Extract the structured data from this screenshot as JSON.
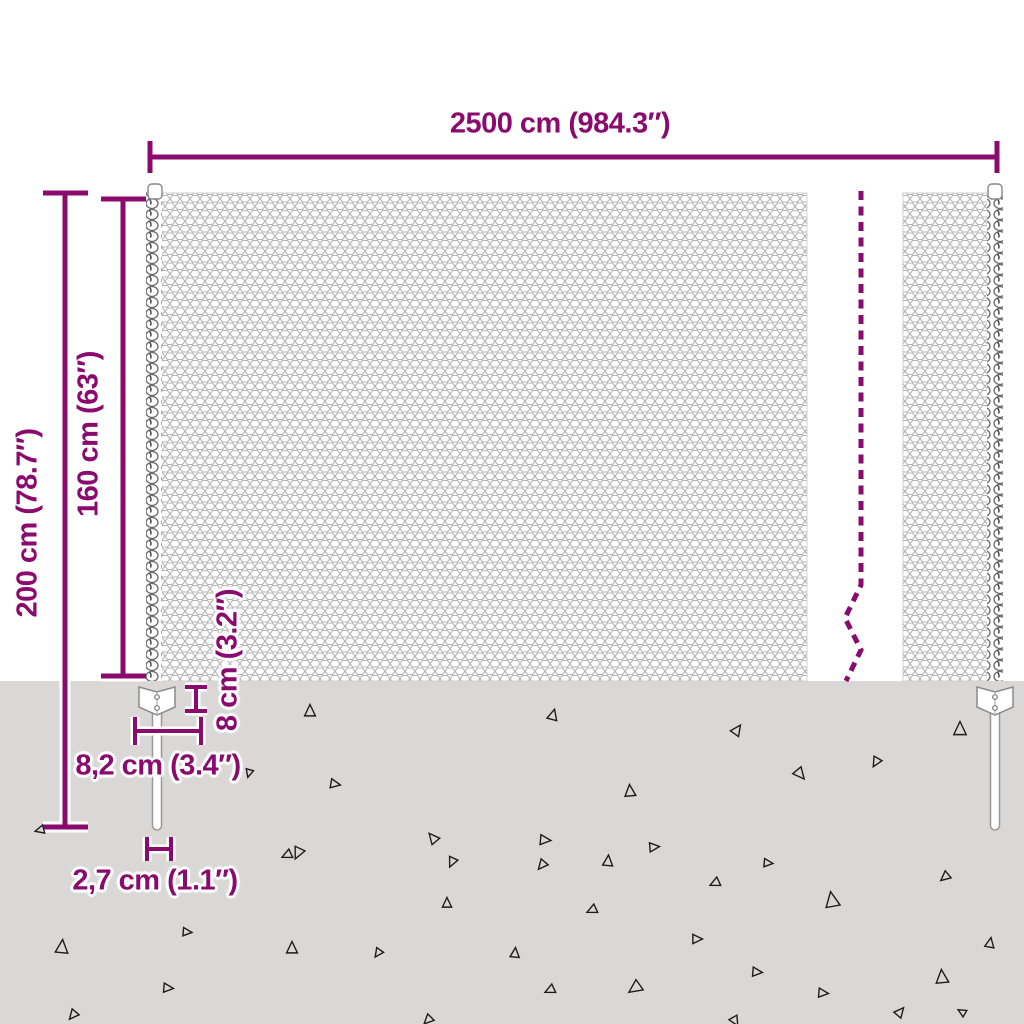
{
  "image_type": "product-dimension-diagram",
  "subject": "chain-link-fence-with-anchor-posts",
  "colors": {
    "accent": "#8a0a6e",
    "background": "#ffffff",
    "ground": "#d9d8d6",
    "mesh_wire": "#b5b5b5",
    "coil_wire": "#6a6a6a",
    "debris": "#1c1c1c"
  },
  "labels": {
    "total_width": "2500 cm (984.3″)",
    "total_height": "200 cm (78.7″)",
    "fence_height": "160 cm (63″)",
    "anchor_depth": "8 cm (3.2″)",
    "anchor_width": "8,2 cm (3.4″)",
    "stake_width": "2,7 cm (1.1″)"
  },
  "ground": {
    "surface_y": 681,
    "triangles": [
      {
        "x": 310,
        "y": 711,
        "s": 13,
        "r": 0
      },
      {
        "x": 553,
        "y": 715,
        "s": 12,
        "r": 15
      },
      {
        "x": 737,
        "y": 730,
        "s": 12,
        "r": 35
      },
      {
        "x": 960,
        "y": 729,
        "s": 15,
        "r": 0
      },
      {
        "x": 876,
        "y": 762,
        "s": 11,
        "r": 210
      },
      {
        "x": 800,
        "y": 774,
        "s": 13,
        "r": 140
      },
      {
        "x": 630,
        "y": 791,
        "s": 13,
        "r": 355
      },
      {
        "x": 335,
        "y": 784,
        "s": 11,
        "r": 100
      },
      {
        "x": 249,
        "y": 773,
        "s": 9,
        "r": 195
      },
      {
        "x": 40,
        "y": 830,
        "s": 10,
        "r": 255
      },
      {
        "x": 298,
        "y": 853,
        "s": 13,
        "r": 205
      },
      {
        "x": 433,
        "y": 838,
        "s": 12,
        "r": 320
      },
      {
        "x": 545,
        "y": 840,
        "s": 12,
        "r": 95
      },
      {
        "x": 654,
        "y": 847,
        "s": 11,
        "r": 85
      },
      {
        "x": 608,
        "y": 861,
        "s": 12,
        "r": 5
      },
      {
        "x": 452,
        "y": 862,
        "s": 11,
        "r": 205
      },
      {
        "x": 287,
        "y": 855,
        "s": 11,
        "r": 245
      },
      {
        "x": 62,
        "y": 947,
        "s": 15,
        "r": 5
      },
      {
        "x": 187,
        "y": 932,
        "s": 10,
        "r": 95
      },
      {
        "x": 292,
        "y": 948,
        "s": 13,
        "r": 0
      },
      {
        "x": 378,
        "y": 953,
        "s": 10,
        "r": 215
      },
      {
        "x": 447,
        "y": 903,
        "s": 11,
        "r": 0
      },
      {
        "x": 168,
        "y": 988,
        "s": 11,
        "r": 95
      },
      {
        "x": 73,
        "y": 1015,
        "s": 11,
        "r": 220
      },
      {
        "x": 428,
        "y": 1020,
        "s": 11,
        "r": 225
      },
      {
        "x": 542,
        "y": 865,
        "s": 11,
        "r": 220
      },
      {
        "x": 768,
        "y": 863,
        "s": 10,
        "r": 95
      },
      {
        "x": 715,
        "y": 883,
        "s": 11,
        "r": 245
      },
      {
        "x": 945,
        "y": 877,
        "s": 11,
        "r": 230
      },
      {
        "x": 592,
        "y": 910,
        "s": 11,
        "r": 245
      },
      {
        "x": 832,
        "y": 900,
        "s": 17,
        "r": 350
      },
      {
        "x": 697,
        "y": 939,
        "s": 11,
        "r": 90
      },
      {
        "x": 515,
        "y": 953,
        "s": 11,
        "r": 5
      },
      {
        "x": 757,
        "y": 972,
        "s": 11,
        "r": 95
      },
      {
        "x": 990,
        "y": 943,
        "s": 11,
        "r": 10
      },
      {
        "x": 942,
        "y": 977,
        "s": 15,
        "r": 355
      },
      {
        "x": 550,
        "y": 990,
        "s": 11,
        "r": 245
      },
      {
        "x": 635,
        "y": 988,
        "s": 15,
        "r": 235
      },
      {
        "x": 823,
        "y": 993,
        "s": 11,
        "r": 95
      },
      {
        "x": 900,
        "y": 1012,
        "s": 11,
        "r": 40
      },
      {
        "x": 735,
        "y": 1021,
        "s": 11,
        "r": 150
      },
      {
        "x": 962,
        "y": 1012,
        "s": 9,
        "r": 300
      }
    ]
  }
}
